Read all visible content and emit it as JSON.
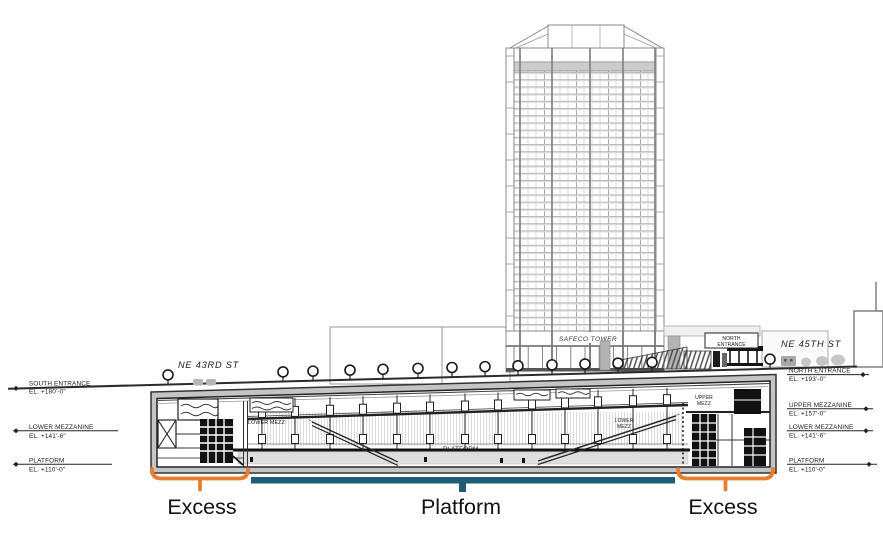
{
  "streets": {
    "ne_43rd": "NE 43RD ST",
    "ne_45th": "NE 45TH ST"
  },
  "tower_label": "SAFECO TOWER",
  "north_entrance_box": {
    "line1": "NORTH",
    "line2": "ENTRANCE"
  },
  "elevations": {
    "left": [
      {
        "name": "SOUTH ENTRANCE",
        "el": "EL. +180'-0\""
      },
      {
        "name": "LOWER MEZZANINE",
        "el": "EL. +141'-6\""
      },
      {
        "name": "PLATFORM",
        "el": "EL. +110'-0\""
      }
    ],
    "right": [
      {
        "name": "NORTH ENTRANCE",
        "el": "EL. +193'-0\""
      },
      {
        "name": "UPPER MEZZANINE",
        "el": "EL. +157'-0\""
      },
      {
        "name": "LOWER MEZZANINE",
        "el": "EL. +141'-6\""
      },
      {
        "name": "PLATFORM",
        "el": "EL. +110'-0\""
      }
    ]
  },
  "station_labels": {
    "lower_mezz_left": "LOWER MEZZ",
    "lower_mezz_right_line1": "LOWER",
    "lower_mezz_right_line2": "MEZZ",
    "upper_mezz_line1": "UPPER",
    "upper_mezz_line2": "MEZZ",
    "platform": "PLATFORM"
  },
  "annotations": {
    "excess_left": "Excess",
    "platform": "Platform",
    "excess_right": "Excess",
    "excess_color": "#E87D2D",
    "platform_color": "#1F5C78"
  }
}
